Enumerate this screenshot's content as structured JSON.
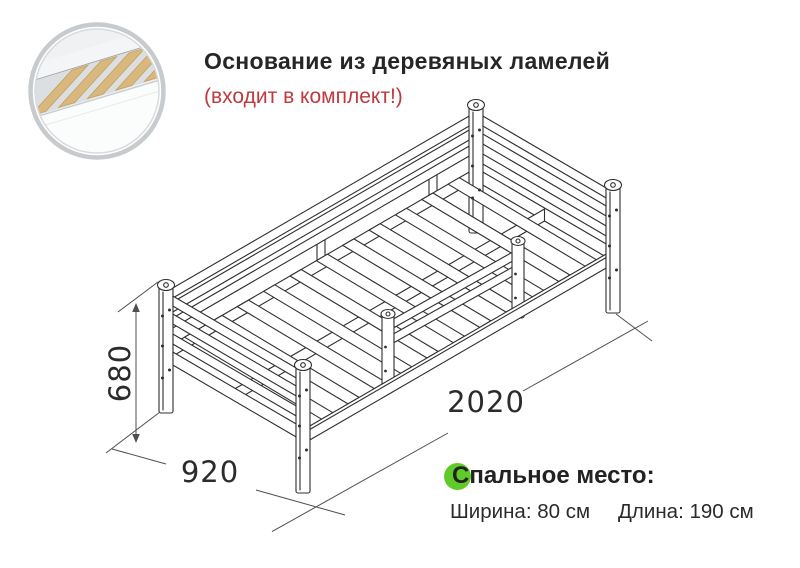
{
  "header": {
    "title": "Основание из деревяных ламелей",
    "subtitle": "(входит в комплект!)"
  },
  "dimensions": {
    "height": "680",
    "depth": "920",
    "length": "2020"
  },
  "sleeping_area": {
    "heading": "Спальное место:",
    "width": "Ширина: 80 см",
    "length": "Длина: 190 см"
  },
  "inset": {
    "icon": "wood-slats-base-photo"
  },
  "colors": {
    "title_text": "#262626",
    "subtitle_red": "#bf393e",
    "green_bullet": "#5fcb2a",
    "drawing_line": "#2f2f2f",
    "dimension_line": "#4f4f4f",
    "wood_slat": "#d9b87e"
  }
}
